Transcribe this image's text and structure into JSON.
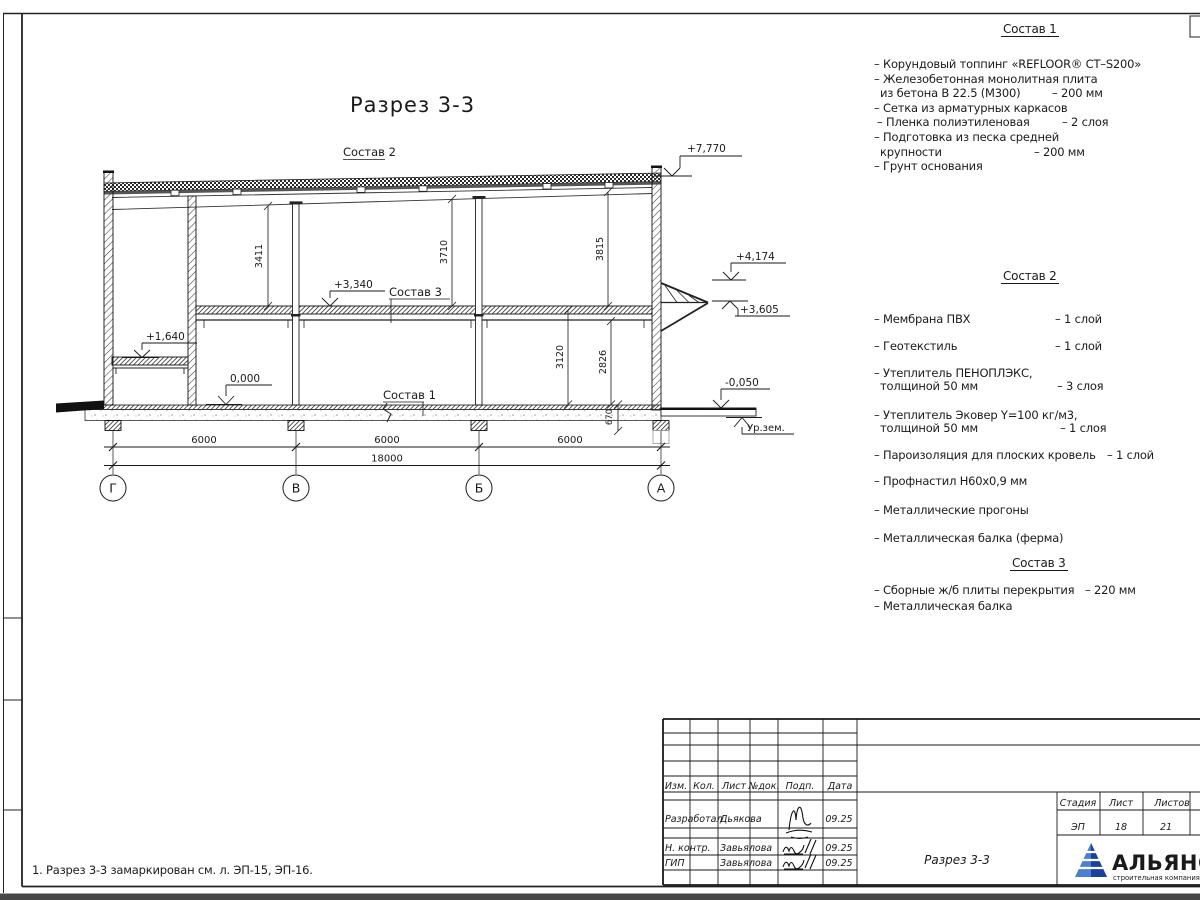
{
  "page": {
    "note": "1. Разрез 3-3 замаркирован см. л. ЭП-15, ЭП-16."
  },
  "colors": {
    "logo_blue": "#1c3f9e",
    "logo_light": "#4a7fd4",
    "line_color": "#1a1a1a"
  },
  "drawing": {
    "title": "Разрез 3-3",
    "composition_labels": {
      "c1": "Состав 1",
      "c2": "Состав 2",
      "c3": "Состав 3"
    },
    "ground_label": "Ур.зем.",
    "elevations": {
      "roof": "+7,770",
      "canopy_top": "+4,174",
      "canopy_bottom": "+3,605",
      "floor2": "+3,340",
      "mezzanine": "+1,640",
      "zero": "0,000",
      "apron": "-0,050"
    },
    "dims": {
      "h_v": "3411",
      "h_b": "3710",
      "h_a": "3815",
      "f_b": "3120",
      "f_b2": "2826",
      "plinth": "670",
      "bay": "6000",
      "total": "18000"
    },
    "axes": [
      "Г",
      "В",
      "Б",
      "А"
    ]
  },
  "materials": {
    "list1": {
      "title": "Состав 1",
      "lines": [
        {
          "text": "– Корундовый топпинг «REFLOOR® CT–S200»",
          "value": ""
        },
        {
          "text": "– Железобетонная  монолитная плита",
          "value": ""
        },
        {
          "text": "из бетона В 22.5 (М300)",
          "value": "– 200 мм"
        },
        {
          "text": "– Сетка из арматурных каркасов",
          "value": ""
        },
        {
          "text": "– Пленка полиэтиленовая",
          "value": "– 2 слоя"
        },
        {
          "text": "– Подготовка из песка средней",
          "value": ""
        },
        {
          "text": "крупности",
          "value": "– 200 мм"
        },
        {
          "text": "– Грунт основания",
          "value": ""
        }
      ]
    },
    "list2": {
      "title": "Состав 2",
      "lines": [
        {
          "text": "– Мембрана ПВХ",
          "value": "– 1 слой"
        },
        {
          "text": "– Геотекстиль",
          "value": "– 1 слой"
        },
        {
          "text": "– Утеплитель ПЕНОПЛЭКС,",
          "value": ""
        },
        {
          "text": "толщиной 50 мм",
          "value": "– 3 слоя"
        },
        {
          "text": "– Утеплитель Эковер Y=100 кг/м3,",
          "value": ""
        },
        {
          "text": "толщиной 50 мм",
          "value": "– 1 слоя"
        },
        {
          "text": "– Пароизоляция для плоских кровель",
          "value": "– 1 слой"
        },
        {
          "text": "– Профнастил Н60х0,9 мм",
          "value": ""
        },
        {
          "text": "– Металлические прогоны",
          "value": ""
        },
        {
          "text": "– Металлическая балка (ферма)",
          "value": ""
        }
      ]
    },
    "list3": {
      "title": "Состав 3",
      "lines": [
        {
          "text": "– Сборные ж/б плиты перекрытия",
          "value": "– 220 мм"
        },
        {
          "text": "– Металлическая балка",
          "value": ""
        }
      ]
    }
  },
  "stamp": {
    "cols": [
      "Изм.",
      "Кол.",
      "Лист",
      "№док.",
      "Подп.",
      "Дата"
    ],
    "rows": [
      {
        "role": "Разработал",
        "name": "Дьякова",
        "date": "09.25"
      },
      {
        "role": "Н. контр.",
        "name": "Завьялова",
        "date": "09.25"
      },
      {
        "role": "ГИП",
        "name": "Завьялова",
        "date": "09.25"
      }
    ],
    "doc_title": "Разрез 3-3",
    "stage_label": "Стадия",
    "sheet_label": "Лист",
    "sheets_label": "Листов",
    "stage": "ЭП",
    "sheet": "18",
    "sheets": "21",
    "logo": {
      "name": "АЛЬЯНС",
      "tagline": "строительная компания"
    }
  }
}
